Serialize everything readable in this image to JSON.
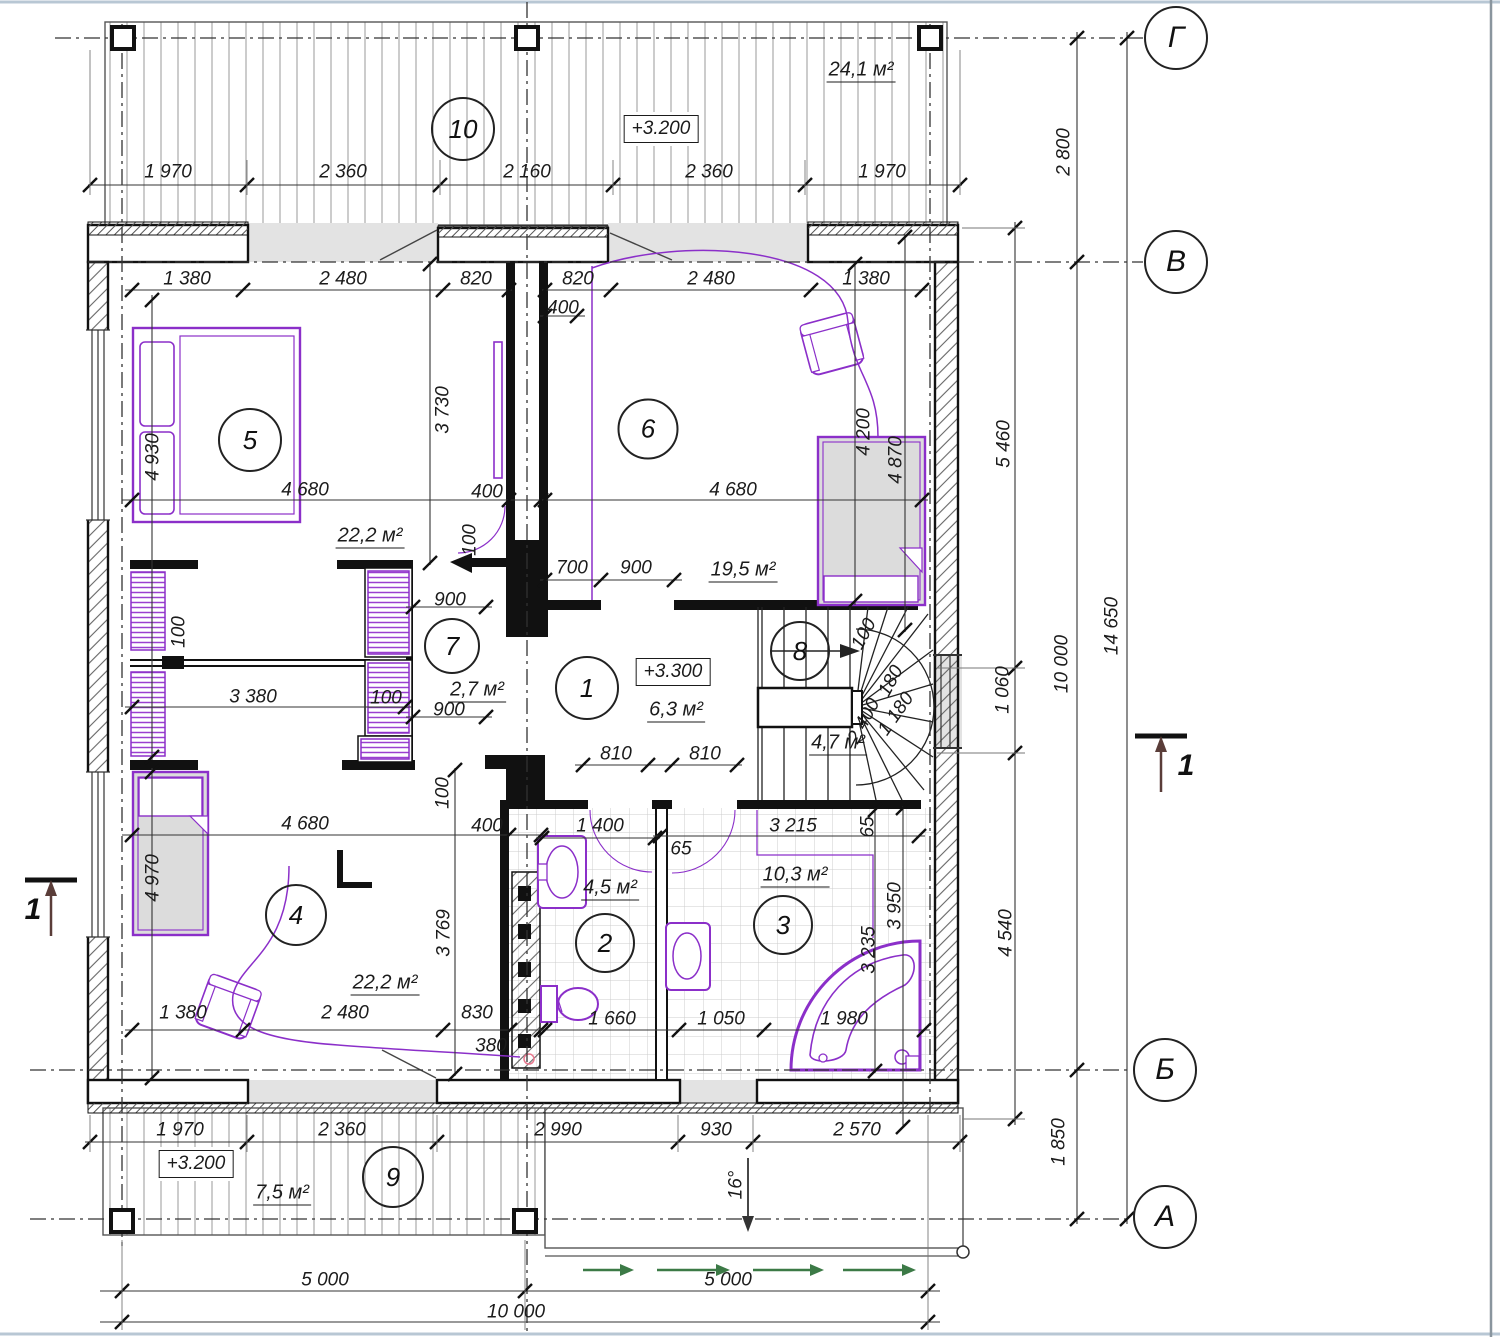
{
  "drawing": {
    "type": "architectural floor plan",
    "elevation_marks": [
      {
        "text": "+3.200",
        "x": 661,
        "y": 129
      },
      {
        "text": "+3.300",
        "x": 673,
        "y": 672
      },
      {
        "text": "+3.200",
        "x": 196,
        "y": 1164
      }
    ],
    "axis_markers": [
      {
        "label": "Г",
        "x": 1176,
        "y": 38
      },
      {
        "label": "В",
        "x": 1176,
        "y": 262
      },
      {
        "label": "Б",
        "x": 1165,
        "y": 1070
      },
      {
        "label": "А",
        "x": 1165,
        "y": 1217
      }
    ],
    "section_markers": [
      {
        "label": "1",
        "x": 33,
        "y": 910
      },
      {
        "label": "1",
        "x": 1186,
        "y": 766
      }
    ],
    "room_markers": [
      {
        "number": "1",
        "x": 587,
        "y": 688,
        "d": 60
      },
      {
        "number": "2",
        "x": 605,
        "y": 943,
        "d": 56
      },
      {
        "number": "3",
        "x": 783,
        "y": 925,
        "d": 56
      },
      {
        "number": "4",
        "x": 296,
        "y": 915,
        "d": 58
      },
      {
        "number": "5",
        "x": 250,
        "y": 440,
        "d": 60
      },
      {
        "number": "6",
        "x": 648,
        "y": 429,
        "d": 57
      },
      {
        "number": "7",
        "x": 452,
        "y": 646,
        "d": 52
      },
      {
        "number": "8",
        "x": 800,
        "y": 651,
        "d": 56
      },
      {
        "number": "9",
        "x": 393,
        "y": 1177,
        "d": 58
      },
      {
        "number": "10",
        "x": 463,
        "y": 129,
        "d": 60
      }
    ],
    "area_labels": [
      {
        "text": "24,1 м²",
        "x": 861,
        "y": 71
      },
      {
        "text": "22,2 м²",
        "x": 370,
        "y": 537
      },
      {
        "text": "19,5 м²",
        "x": 743,
        "y": 571
      },
      {
        "text": "2,7 м²",
        "x": 477,
        "y": 691
      },
      {
        "text": "6,3 м²",
        "x": 676,
        "y": 711
      },
      {
        "text": "4,7 м²",
        "x": 838,
        "y": 744
      },
      {
        "text": "4,5 м²",
        "x": 610,
        "y": 889
      },
      {
        "text": "10,3 м²",
        "x": 795,
        "y": 876
      },
      {
        "text": "22,2 м²",
        "x": 385,
        "y": 984
      },
      {
        "text": "7,5 м²",
        "x": 282,
        "y": 1194
      }
    ],
    "dim_labels": [
      {
        "t": "1 970",
        "x": 168,
        "y": 172
      },
      {
        "t": "2 360",
        "x": 343,
        "y": 172
      },
      {
        "t": "2 160",
        "x": 527,
        "y": 172
      },
      {
        "t": "2 360",
        "x": 709,
        "y": 172
      },
      {
        "t": "1 970",
        "x": 882,
        "y": 172
      },
      {
        "t": "1 380",
        "x": 187,
        "y": 279
      },
      {
        "t": "2 480",
        "x": 343,
        "y": 279
      },
      {
        "t": "820",
        "x": 476,
        "y": 279
      },
      {
        "t": "820",
        "x": 578,
        "y": 279
      },
      {
        "t": "2 480",
        "x": 711,
        "y": 279
      },
      {
        "t": "1 380",
        "x": 866,
        "y": 279
      },
      {
        "t": "400",
        "x": 563,
        "y": 308
      },
      {
        "t": "4 930",
        "x": 153,
        "y": 457,
        "r": -90
      },
      {
        "t": "3 730",
        "x": 443,
        "y": 410,
        "r": -90
      },
      {
        "t": "4 680",
        "x": 305,
        "y": 490
      },
      {
        "t": "400",
        "x": 487,
        "y": 492
      },
      {
        "t": "4 680",
        "x": 733,
        "y": 490
      },
      {
        "t": "4 200",
        "x": 864,
        "y": 432,
        "r": -90
      },
      {
        "t": "4 870",
        "x": 896,
        "y": 460,
        "r": -90
      },
      {
        "t": "100",
        "x": 470,
        "y": 540,
        "r": -90
      },
      {
        "t": "700",
        "x": 572,
        "y": 568
      },
      {
        "t": "900",
        "x": 636,
        "y": 568
      },
      {
        "t": "900",
        "x": 450,
        "y": 600
      },
      {
        "t": "100",
        "x": 179,
        "y": 632,
        "r": -90
      },
      {
        "t": "3 380",
        "x": 253,
        "y": 697
      },
      {
        "t": "100",
        "x": 386,
        "y": 698
      },
      {
        "t": "900",
        "x": 449,
        "y": 710
      },
      {
        "t": "810",
        "x": 616,
        "y": 754
      },
      {
        "t": "810",
        "x": 705,
        "y": 754
      },
      {
        "t": "100",
        "x": 864,
        "y": 634,
        "r": -62
      },
      {
        "t": "180",
        "x": 891,
        "y": 681,
        "r": -62
      },
      {
        "t": "2 400",
        "x": 864,
        "y": 721,
        "r": -62
      },
      {
        "t": "1 180",
        "x": 896,
        "y": 714,
        "r": -55
      },
      {
        "t": "100",
        "x": 443,
        "y": 793,
        "r": -90
      },
      {
        "t": "4 680",
        "x": 305,
        "y": 824
      },
      {
        "t": "400",
        "x": 487,
        "y": 826
      },
      {
        "t": "1 400",
        "x": 600,
        "y": 826
      },
      {
        "t": "65",
        "x": 681,
        "y": 849
      },
      {
        "t": "3 215",
        "x": 793,
        "y": 826
      },
      {
        "t": "65",
        "x": 868,
        "y": 827,
        "r": -90
      },
      {
        "t": "4 970",
        "x": 153,
        "y": 878,
        "r": -90
      },
      {
        "t": "3 769",
        "x": 444,
        "y": 933,
        "r": -90
      },
      {
        "t": "3 235",
        "x": 869,
        "y": 950,
        "r": -90
      },
      {
        "t": "3 950",
        "x": 895,
        "y": 906,
        "r": -90
      },
      {
        "t": "1 380",
        "x": 183,
        "y": 1013
      },
      {
        "t": "2 480",
        "x": 345,
        "y": 1013
      },
      {
        "t": "830",
        "x": 477,
        "y": 1013
      },
      {
        "t": "380",
        "x": 491,
        "y": 1046
      },
      {
        "t": "1 660",
        "x": 612,
        "y": 1019
      },
      {
        "t": "1 050",
        "x": 721,
        "y": 1019
      },
      {
        "t": "1 980",
        "x": 844,
        "y": 1019
      },
      {
        "t": "1 970",
        "x": 180,
        "y": 1130
      },
      {
        "t": "2 360",
        "x": 342,
        "y": 1130
      },
      {
        "t": "2 990",
        "x": 558,
        "y": 1130
      },
      {
        "t": "930",
        "x": 716,
        "y": 1130
      },
      {
        "t": "2 570",
        "x": 857,
        "y": 1130
      },
      {
        "t": "5 000",
        "x": 325,
        "y": 1280
      },
      {
        "t": "5 000",
        "x": 728,
        "y": 1280
      },
      {
        "t": "10 000",
        "x": 516,
        "y": 1312
      },
      {
        "t": "2 800",
        "x": 1064,
        "y": 152,
        "r": -90
      },
      {
        "t": "5 460",
        "x": 1004,
        "y": 444,
        "r": -90
      },
      {
        "t": "10 000",
        "x": 1062,
        "y": 664,
        "r": -90
      },
      {
        "t": "14 650",
        "x": 1112,
        "y": 626,
        "r": -90
      },
      {
        "t": "1 060",
        "x": 1003,
        "y": 690,
        "r": -90
      },
      {
        "t": "4 540",
        "x": 1006,
        "y": 933,
        "r": -90
      },
      {
        "t": "1 850",
        "x": 1059,
        "y": 1142,
        "r": -90
      }
    ],
    "angle_label": {
      "text": "16°",
      "x": 736,
      "y": 1185,
      "r": -90
    },
    "colors": {
      "furniture_accent": "#8b2fc9",
      "wall_line": "#111111",
      "dim_line": "#333333",
      "gray_fill": "#e3e3e3",
      "green_arrow": "#3c7a46",
      "section_arrow": "#5a3d39",
      "frame_edge": "#b8c7d4"
    }
  }
}
